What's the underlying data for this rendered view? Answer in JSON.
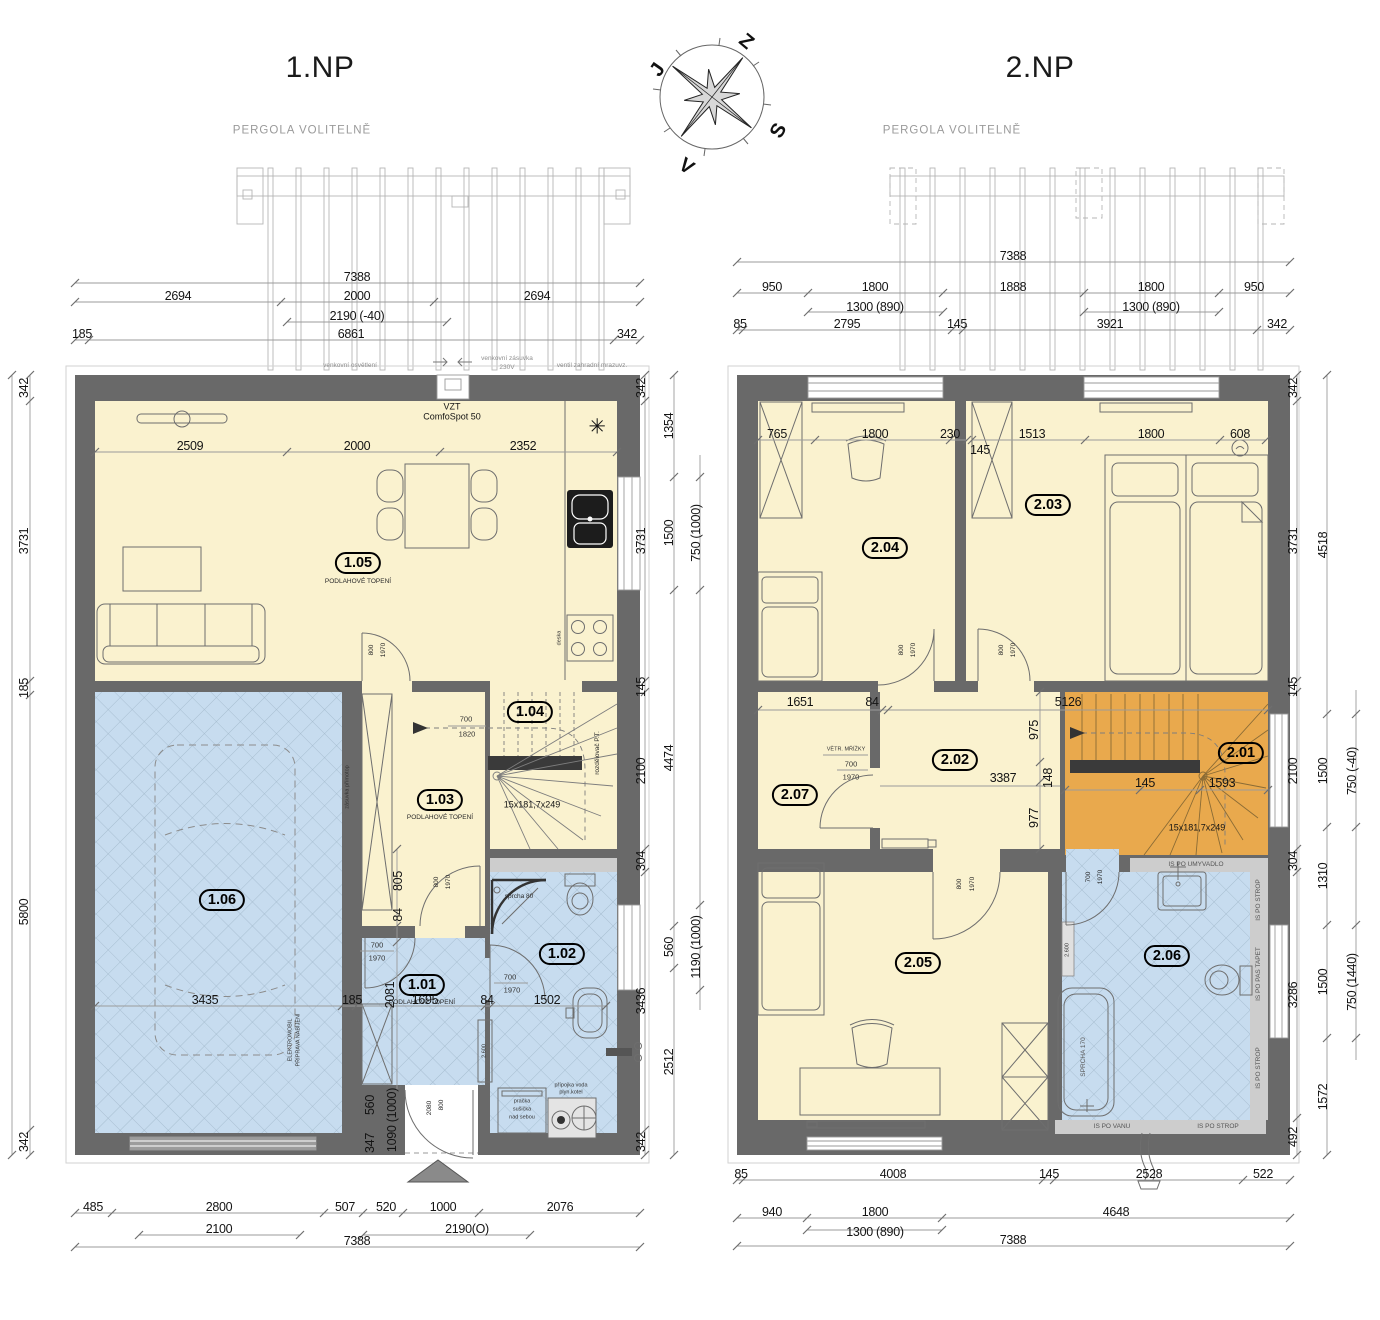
{
  "colors": {
    "wall": "#696969",
    "room_yellow": "#faf2cf",
    "room_blue": "#c7dcef",
    "stairs_orange": "#e9a94d",
    "strip_gray": "#cdcdcd",
    "dim_line": "#9b9b9b"
  },
  "compass": {
    "z": "Z",
    "j": "J",
    "s": "S",
    "v": "V"
  },
  "np1": {
    "title": "1.NP",
    "pergola": "PERGOLA VOLITELNĚ",
    "top1": [
      "7388"
    ],
    "top2": [
      "2694",
      "2000",
      "2694"
    ],
    "top3": [
      "2190 (-40)"
    ],
    "top4": [
      "185",
      "6861",
      "342"
    ],
    "ann": [
      "venkovní osvětlení",
      "venkovní zásuvka",
      "230V",
      "ventil zahradní mrazuvz.",
      "VZT",
      "ComfoSpot 50"
    ],
    "roomdims": [
      "2509",
      "2000",
      "2352"
    ],
    "badges": {
      "r105": "1.05",
      "r104": "1.04",
      "r103": "1.03",
      "r101": "1.01",
      "r102": "1.02",
      "r106": "1.06"
    },
    "floor_heating": "PODLAHOVÉ TOPENÍ",
    "fridge_icon": "✳",
    "deska": "deska",
    "stair": {
      "steps": "15x181,7x249",
      "w": "700",
      "h": "1820",
      "rozdel": "rozdělovač P.T."
    },
    "door800": "800",
    "door1970": "1970",
    "door700": "700",
    "sprcha": "sprcha 80",
    "zasuvka": "zásuvka přímotop",
    "elektro1": "ELEKTROMOBIL",
    "elektro2": "PŘÍPRAVA NABÍJENÍ",
    "pracka": [
      "pračka",
      "sušička",
      "nad sebou"
    ],
    "pripojka": [
      "přípojka voda",
      "plyn.kotel"
    ],
    "h2600": "2.600",
    "mid": [
      "3435",
      "185",
      "1695",
      "84",
      "1502"
    ],
    "v805": "805",
    "v84": "84",
    "v2081": "2081",
    "v560": "560",
    "v347": "347",
    "v1090": "1090 (1000)",
    "v2080": "2080",
    "v800": "800",
    "bottom1": [
      "485",
      "2800",
      "507",
      "520",
      "1000",
      "2076"
    ],
    "bottom2": [
      "2100",
      "2190(O)"
    ],
    "bottom3": [
      "7388"
    ],
    "left": [
      "342",
      "3731",
      "185",
      "5800",
      "342"
    ],
    "right1": [
      "342",
      "3731",
      "145",
      "2100",
      "304",
      "3436",
      "342"
    ],
    "right2": [
      "1354",
      "1500",
      "4474",
      "560",
      "2512"
    ],
    "right3": [
      "750 (1000)",
      "1190 (1000)"
    ]
  },
  "np2": {
    "title": "2.NP",
    "pergola": "PERGOLA VOLITELNĚ",
    "top1": [
      "7388"
    ],
    "top2": [
      "950",
      "1800",
      "1888",
      "1800",
      "950"
    ],
    "top3": [
      "1300 (890)",
      "1300 (890)"
    ],
    "top4": [
      "85",
      "2795",
      "145",
      "3921",
      "342"
    ],
    "roomdims": [
      "765",
      "1800",
      "230",
      "145",
      "1513",
      "1800",
      "608"
    ],
    "badges": {
      "r201": "2.01",
      "r202": "2.02",
      "r203": "2.03",
      "r204": "2.04",
      "r205": "2.05",
      "r206": "2.06",
      "r207": "2.07"
    },
    "mid1": [
      "1651",
      "84",
      "5126"
    ],
    "v975": "975",
    "v148": "148",
    "v977": "977",
    "h3387": "3387",
    "m145": "145",
    "m1593": "1593",
    "steps": "15x181,7x249",
    "vetr": "VĚTR. MŘÍŽKY",
    "door800": "800",
    "door1970": "1970",
    "door700": "700",
    "strips": {
      "umyvadlo": "IS PO UMYVADLO",
      "strop": "IS PO STROP",
      "pastapet": "IS PO PAS TAPET",
      "vanu": "IS PO VANU"
    },
    "sprcha170": "SPRCHA 170",
    "h2600": "2.600",
    "bottom1": [
      "85",
      "4008",
      "145",
      "2528",
      "522"
    ],
    "bottom2": [
      "940",
      "1800",
      "4648"
    ],
    "bottom3": [
      "1300 (890)",
      "7388"
    ],
    "right1": [
      "342",
      "3731",
      "145",
      "2100",
      "304",
      "3286",
      "492"
    ],
    "right2": [
      "4518",
      "1500",
      "1310",
      "1500",
      "1572"
    ],
    "right3": [
      "750 (-40)",
      "750 (1440)"
    ]
  }
}
